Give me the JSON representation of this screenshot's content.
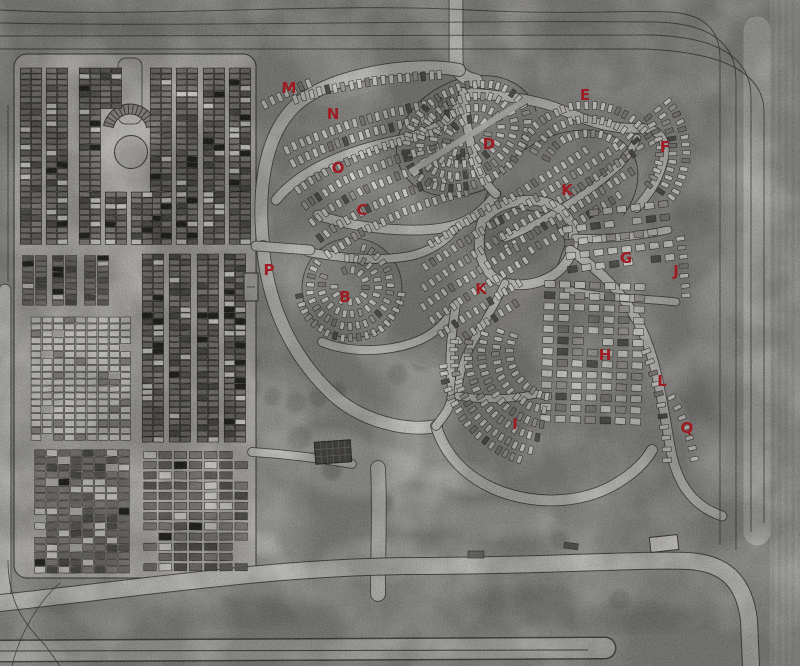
{
  "map": {
    "marker_color": "#9e1b22",
    "palette": {
      "terrain": "#a4a3a0",
      "road": "#d8d7d3",
      "road_edge": "#3e3d39",
      "plot_light": "#eeede9",
      "plot_dark": "#7f7c78",
      "outline": "#45443f"
    },
    "markers": [
      {
        "id": "M",
        "label": "M",
        "x": 289,
        "y": 88
      },
      {
        "id": "N",
        "label": "N",
        "x": 333,
        "y": 114
      },
      {
        "id": "O",
        "label": "O",
        "x": 338,
        "y": 168
      },
      {
        "id": "C",
        "label": "C",
        "x": 362,
        "y": 210
      },
      {
        "id": "D",
        "label": "D",
        "x": 489,
        "y": 144
      },
      {
        "id": "E",
        "label": "E",
        "x": 585,
        "y": 95
      },
      {
        "id": "F",
        "label": "F",
        "x": 665,
        "y": 147
      },
      {
        "id": "K-upper",
        "label": "K",
        "x": 567,
        "y": 190
      },
      {
        "id": "G",
        "label": "G",
        "x": 626,
        "y": 258
      },
      {
        "id": "J",
        "label": "J",
        "x": 676,
        "y": 271
      },
      {
        "id": "P",
        "label": "P",
        "x": 269,
        "y": 270
      },
      {
        "id": "B",
        "label": "B",
        "x": 345,
        "y": 297
      },
      {
        "id": "K-center",
        "label": "K",
        "x": 481,
        "y": 289
      },
      {
        "id": "H",
        "label": "H",
        "x": 605,
        "y": 355
      },
      {
        "id": "L",
        "label": "L",
        "x": 662,
        "y": 381
      },
      {
        "id": "I",
        "label": "I",
        "x": 515,
        "y": 424
      },
      {
        "id": "Q",
        "label": "Q",
        "x": 687,
        "y": 428
      }
    ]
  }
}
